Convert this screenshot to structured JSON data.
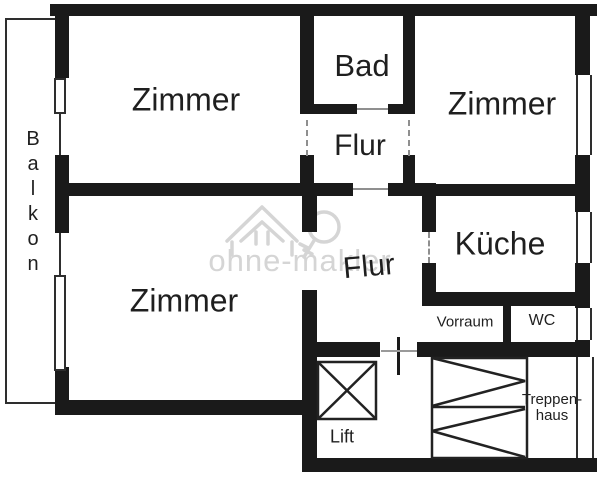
{
  "floorplan": {
    "rooms": [
      {
        "id": "balkon",
        "label": "Balkon"
      },
      {
        "id": "zimmer-top-left",
        "label": "Zimmer"
      },
      {
        "id": "bad",
        "label": "Bad"
      },
      {
        "id": "flur-upper",
        "label": "Flur"
      },
      {
        "id": "zimmer-top-right",
        "label": "Zimmer"
      },
      {
        "id": "kueche",
        "label": "Küche"
      },
      {
        "id": "zimmer-bottom-left",
        "label": "Zimmer"
      },
      {
        "id": "flur-lower",
        "label": "Flur"
      },
      {
        "id": "vorraum",
        "label": "Vorraum"
      },
      {
        "id": "wc",
        "label": "WC"
      },
      {
        "id": "lift",
        "label": "Lift"
      },
      {
        "id": "treppenhaus",
        "label": "Treppen-\nhaus"
      }
    ],
    "watermark": {
      "text": "ohne-makler"
    },
    "colors": {
      "wall": "#1a1a1a",
      "thin_line": "#2e2e2e",
      "door_line": "#8f8f8f",
      "watermark": "#d5d5d5",
      "text": "#1f1f1f",
      "background": "#ffffff"
    }
  }
}
